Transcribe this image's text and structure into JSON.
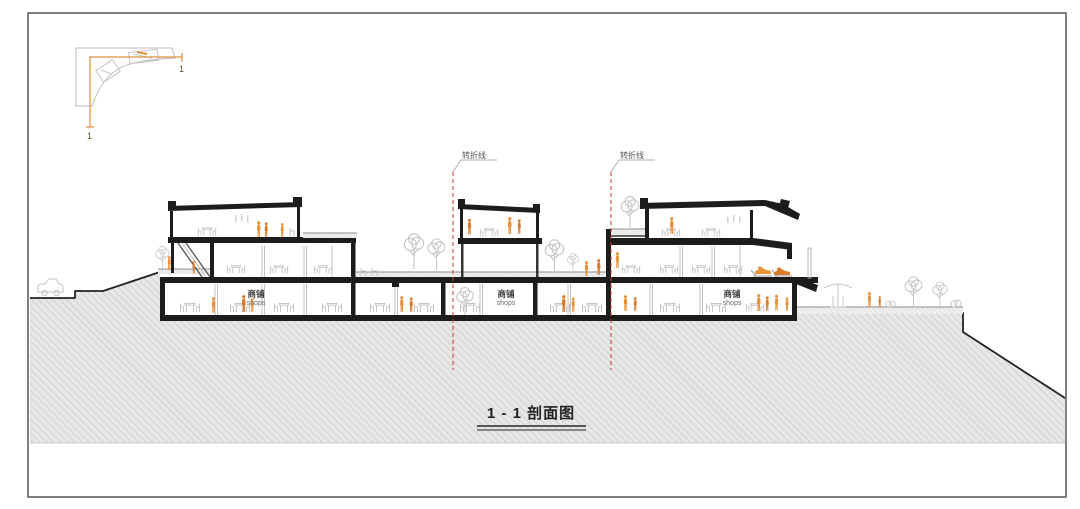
{
  "sheet": {
    "type": "architectural-section-drawing",
    "title": {
      "text": "1 - 1 剖面图"
    },
    "key_plan": {
      "mark_start": "1",
      "mark_end": "1"
    },
    "section_markers": [
      {
        "label": "转折线"
      },
      {
        "label": "转折线"
      }
    ],
    "podium": {
      "shop_labels": [
        {
          "cn": "商铺",
          "en": "shops"
        },
        {
          "cn": "商铺",
          "en": "shops"
        },
        {
          "cn": "商铺",
          "en": "shops"
        }
      ]
    },
    "colors": {
      "orange_figures": "#e8923a",
      "red_dashed_line": "#c23b34",
      "ink_linework": "#1c1c1c",
      "sketch_gray": "#c6c6c6",
      "ground_hatch_bg": "#e7e7e7",
      "ground_hatch_line": "#c5c5c5",
      "key_plan_cut_line": "#dd8f3c"
    }
  }
}
